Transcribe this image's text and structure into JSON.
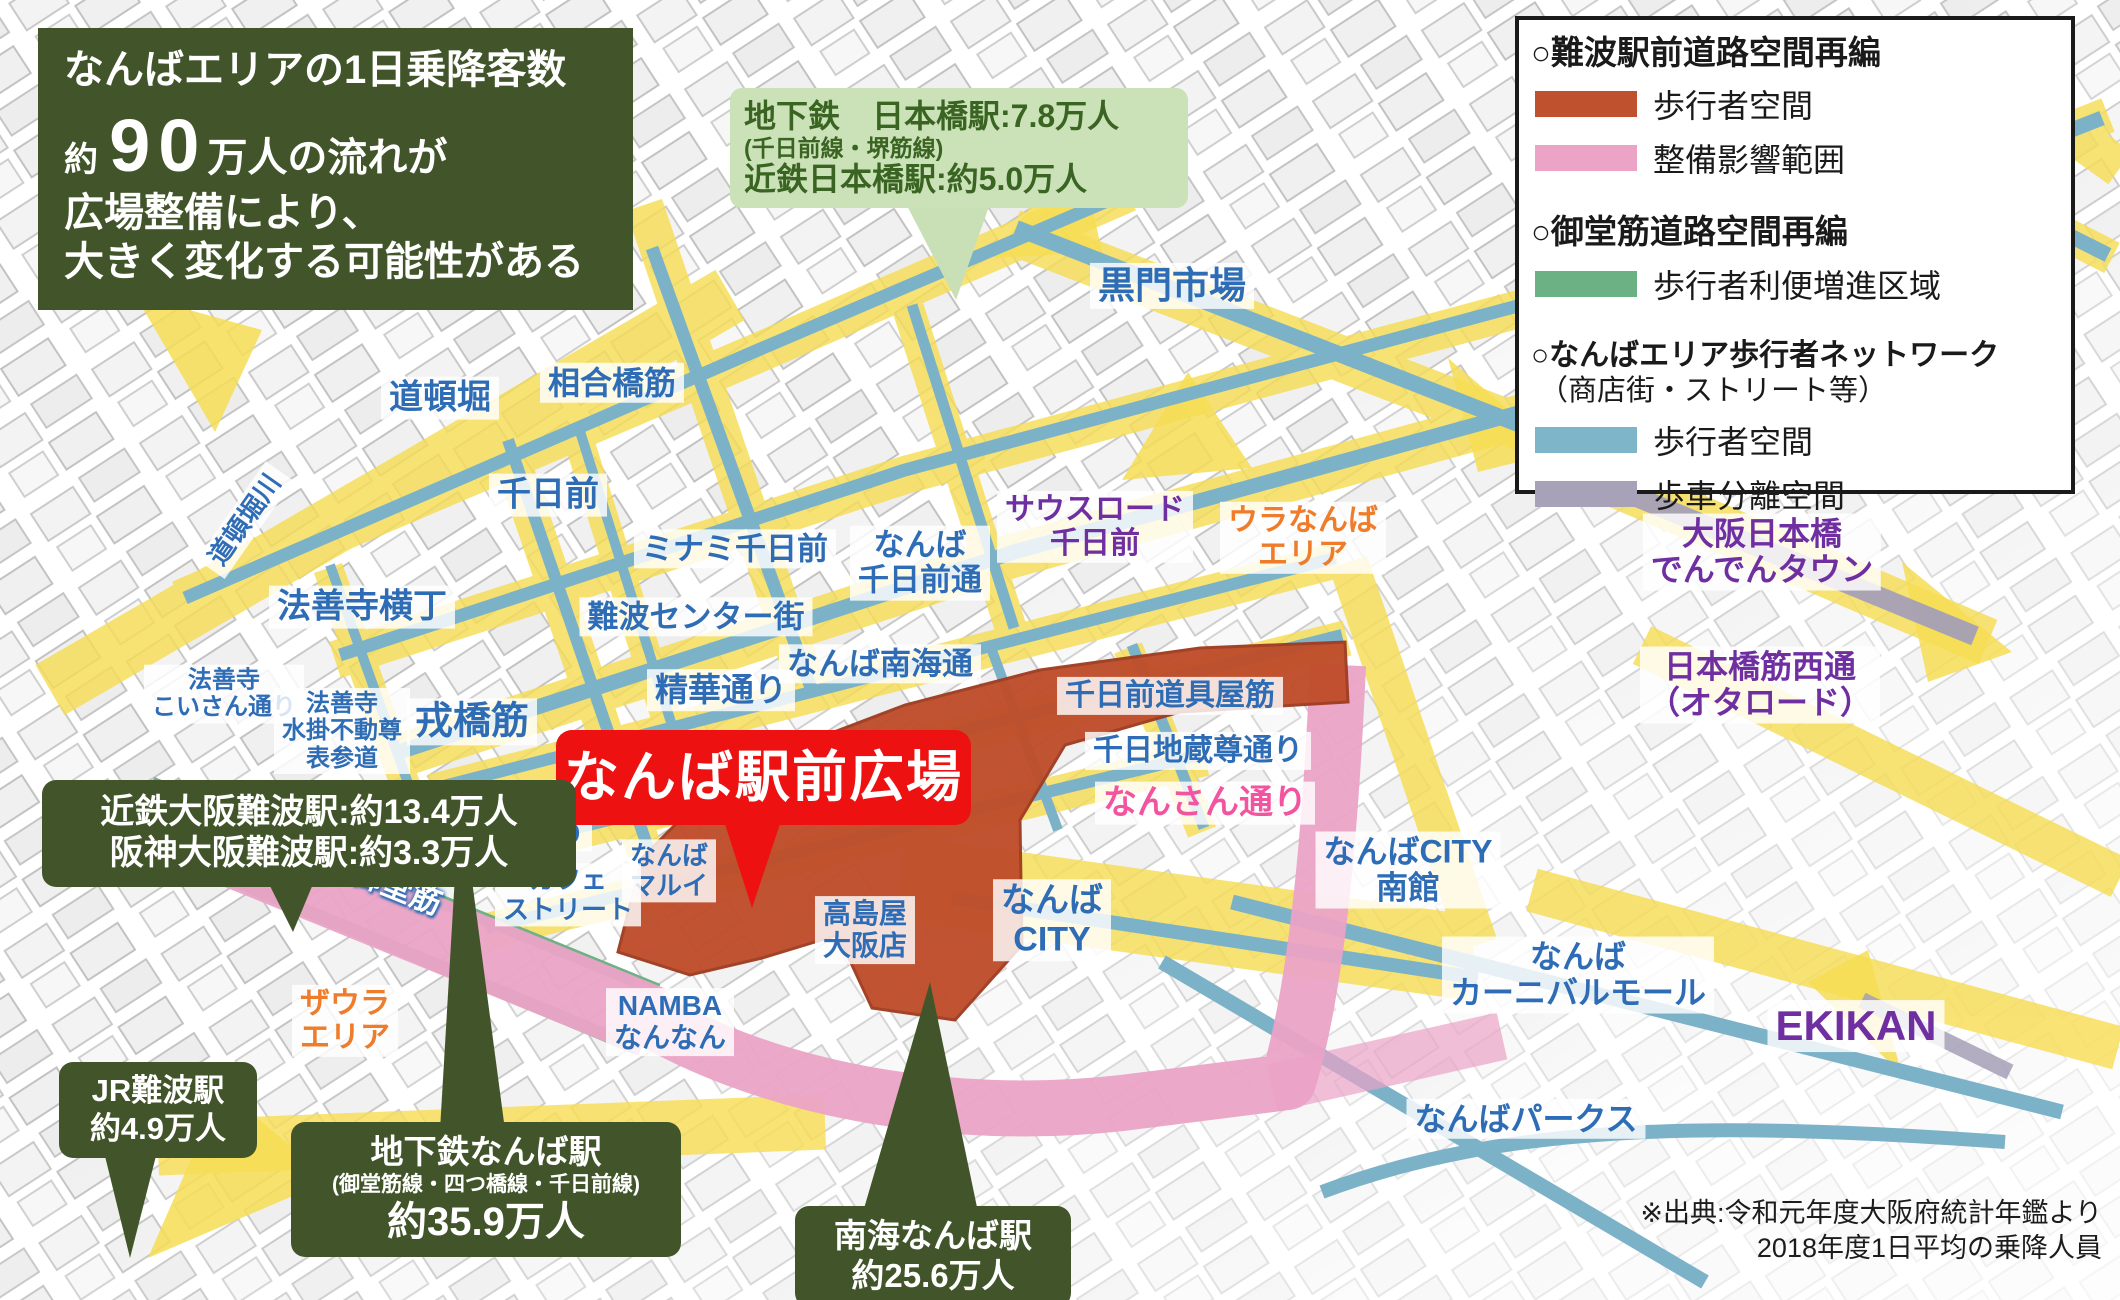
{
  "title_box": {
    "line1": "なんばエリアの1日乗降客数",
    "line2_prefix": "約",
    "line2_big": "90",
    "line2_suffix": "万人の流れが",
    "line3": "広場整備により、",
    "line4": "大きく変化する可能性がある"
  },
  "nipponbashi_callout": {
    "line1": "地下鉄　日本橋駅:7.8万人",
    "line2": "(千日前線・堺筋線)",
    "line3": "近鉄日本橋駅:約5.0万人"
  },
  "legend": {
    "sections": [
      {
        "heading": "○難波駅前道路空間再編",
        "items": [
          {
            "label": "歩行者空間",
            "color": "#c0512e"
          },
          {
            "label": "整備影響範囲",
            "color": "#eba4c5"
          }
        ]
      },
      {
        "heading": "○御堂筋道路空間再編",
        "items": [
          {
            "label": "歩行者利便増進区域",
            "color": "#6cb183"
          }
        ]
      },
      {
        "heading": "○なんばエリア歩行者ネットワーク",
        "subheading": "（商店街・ストリート等）",
        "items": [
          {
            "label": "歩行者空間",
            "color": "#7fb5c9"
          },
          {
            "label": "歩車分離空間",
            "color": "#a8a2b8"
          }
        ]
      }
    ]
  },
  "plaza_banner": "なんば駅前広場",
  "station_callouts": {
    "kintetsu": {
      "line1": "近鉄大阪難波駅:約13.4万人",
      "line2": "阪神大阪難波駅:約3.3万人"
    },
    "jr": {
      "line1": "JR難波駅",
      "line2": "約4.9万人"
    },
    "subway_namba": {
      "line1": "地下鉄なんば駅",
      "line2": "(御堂筋線・四つ橋線・千日前線)",
      "line3": "約35.9万人"
    },
    "nankai": {
      "line1": "南海なんば駅",
      "line2": "約25.6万人"
    }
  },
  "labels": {
    "dotonbori_river": "道頓堀川",
    "dotonbori": "道頓堀",
    "aioibashisuji": "相合橋筋",
    "sennichimae": "千日前",
    "minami_sennichimae": "ミナミ千日前",
    "hozenji_yokocho": "法善寺横丁",
    "hozenji_koisan": "法善寺\nこいさん通り",
    "hozenji_mizukake": "法善寺\n水掛不動尊\n表参道",
    "ebisubashisuji": "戎橋筋",
    "namba_center_gai": "難波センター街",
    "seika_dori": "精華通り",
    "namba_nankai_dori": "なんば南海通",
    "namba_sennichimae_dori": "なんば\n千日前通",
    "south_road_sennichimae": "サウスロード\n千日前",
    "kuromon_ichiba": "黒門市場",
    "ura_namba_area": "ウラなんば\nエリア",
    "sennichimae_doguyasuji": "千日前道具屋筋",
    "sennichi_jizoson_dori": "千日地蔵尊通り",
    "nansan_dori": "なんさん通り",
    "osaka_nipponbashi_denden_town": "大阪日本橋\nでんでんタウン",
    "nipponbashisuji_nishi_dori": "日本橋筋西通\n（オタロード）",
    "namba_city_minamikan": "なんばCITY\n南館",
    "namba_city": "なんば\nCITY",
    "takashimaya_osaka": "高島屋\n大阪店",
    "namba_marui": "なんば\nマルイ",
    "cafe_street": "カフェ\nストリート",
    "namba_hondori": "難波\n本通り",
    "namba_nannan": "NAMBA\nなんなん",
    "the_ura_area": "ザウラ\nエリア",
    "midosuji": "御堂筋",
    "namba_carnival_mall": "なんば\nカーニバルモール",
    "ekikan": "EKIKAN",
    "namba_parks": "なんばパークス"
  },
  "source_note": "※出典:令和元年度大阪府統計年鑑より\n2018年度1日平均の乗降人員",
  "colors": {
    "callout_dark_green": "#42552a",
    "callout_light_green_bg": "#cbe1b8",
    "plaza_banner_red": "#ee1111",
    "plaza_fill": "#bf4e2c",
    "pink_band": "#eba3c6",
    "green_strip": "#6fb185",
    "blue_route": "#7cb2c8",
    "gray_route": "#a49fb6",
    "yellow_road": "#f6dd55",
    "label_blue": "#2e6db6",
    "label_purple": "#6f2fa0",
    "label_orange": "#ee7c2b",
    "label_pink": "#f2549f"
  }
}
